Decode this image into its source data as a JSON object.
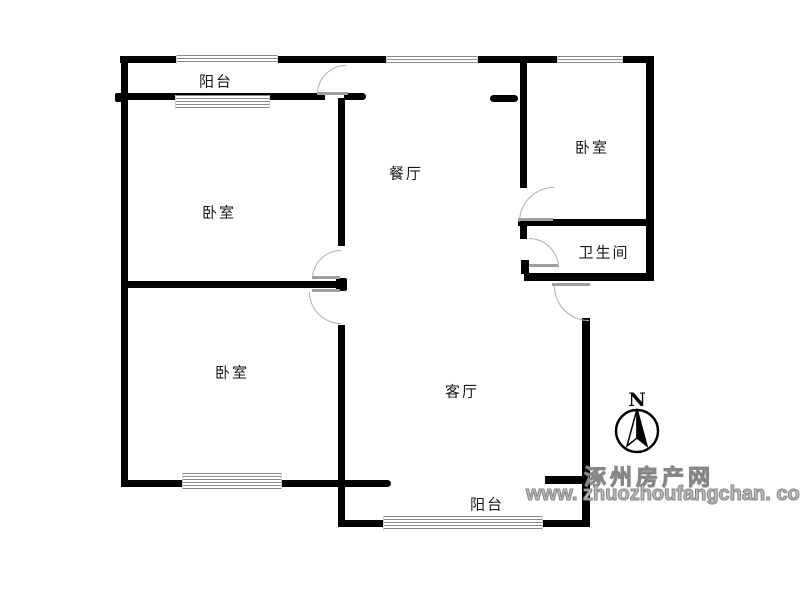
{
  "floorplan": {
    "labels": {
      "balcony_top": "阳台",
      "bedroom_top_left": "卧室",
      "bedroom_bottom_left": "卧室",
      "bedroom_right": "卧室",
      "dining": "餐厅",
      "living": "客厅",
      "bathroom": "卫生间",
      "balcony_bottom": "阳台"
    },
    "compass": {
      "north_label": "N"
    },
    "watermark": {
      "site_name": "涿州房产网",
      "site_url": "www. zhuozhoufangchan. com"
    },
    "colors": {
      "wall": "#000000",
      "window_line": "#8a8a8a",
      "door_arc": "#b0b0b0",
      "label_text": "#1a1a1a",
      "watermark_gray": "#bdbdbd"
    }
  }
}
